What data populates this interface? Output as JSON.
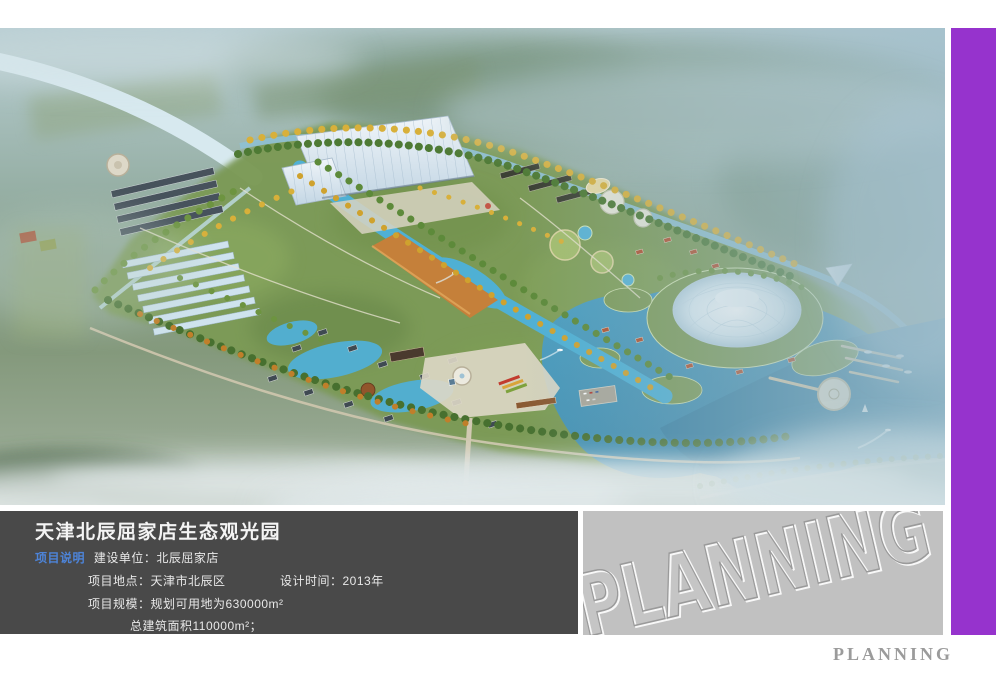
{
  "info_panel": {
    "title": "天津北辰屈家店生态观光园",
    "section_label": "项目说明",
    "fields": {
      "construction_unit": "建设单位：北辰屈家店",
      "location": "项目地点：天津市北辰区",
      "design_time": "设计时间：2013年",
      "scale": "项目规模：规划可用地为630000m²",
      "floor_area": "总建筑面积110000m²；"
    }
  },
  "watermark_panel": {
    "text": "PLANNING"
  },
  "footer": {
    "text": "PLANNING"
  },
  "colors": {
    "accent_purple": "#9633cd",
    "info_panel_bg": "#494949",
    "section_label_blue": "#4d84d9",
    "watermark_panel_bg": "#c1c1c1",
    "footer_text_gray": "#9b9b9b",
    "water_cyan": "#52aecf",
    "lake_teal": "#3f86a8",
    "park_green": "#7c9a57",
    "autumn_yellow": "#d8b03a"
  }
}
